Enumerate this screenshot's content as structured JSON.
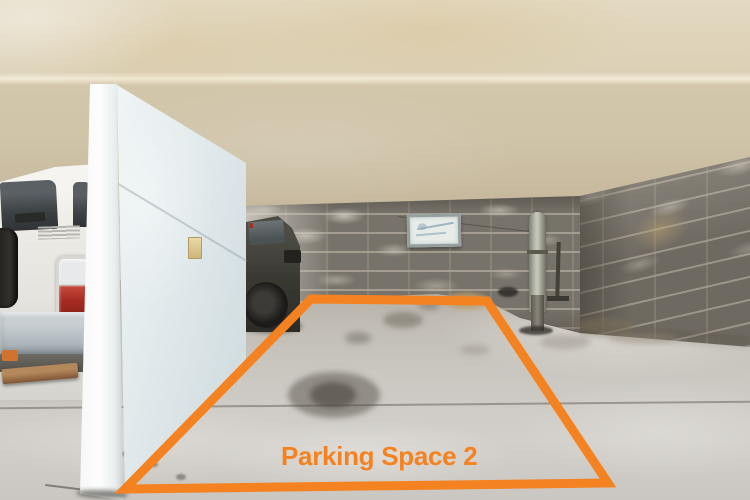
{
  "meta": {
    "type": "photograph",
    "subject": "Underground concrete parking garage with one parking bay highlighted by an orange outline"
  },
  "overlay": {
    "label": "Parking Space 2",
    "accent_color": "#F58220",
    "outline_points": "311,299 487,301 608,483 125,489",
    "outline_stroke_width": "9"
  },
  "scene": {
    "objects": [
      "concrete ceiling and beam",
      "concrete block back wall",
      "concrete block right wall",
      "bare concrete floor with stains",
      "silver SUV parked in adjacent bay",
      "light-blue divider panel wall",
      "dark vehicle behind the panel",
      "framed notice board on wall",
      "vertical drain pipe",
      "thin metal rod",
      "wooden plank under SUV"
    ]
  }
}
